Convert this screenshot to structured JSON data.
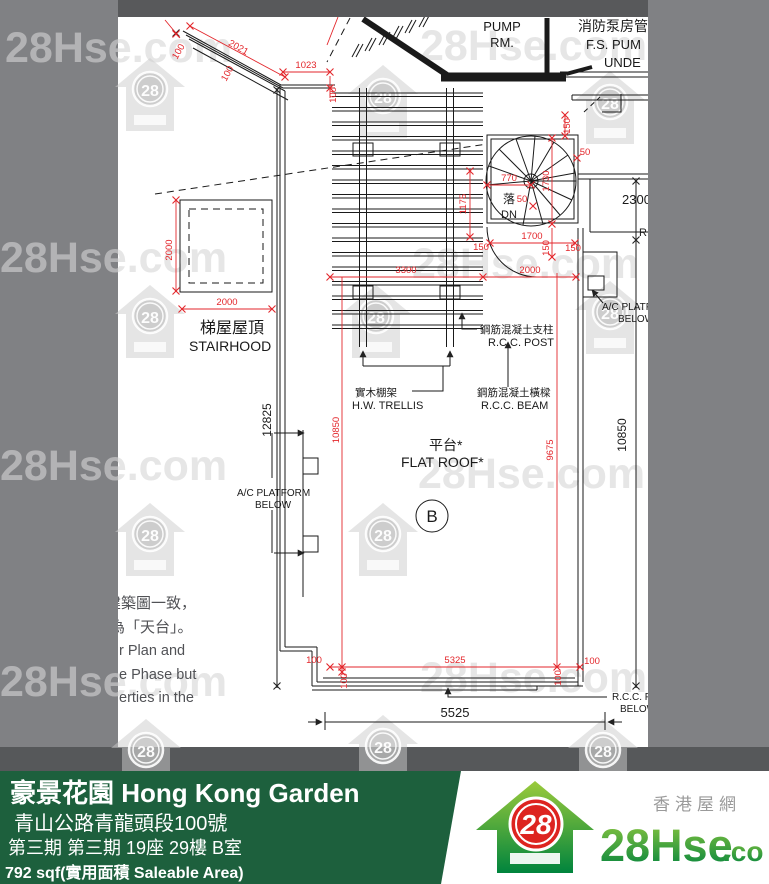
{
  "watermark": {
    "text": "28Hse.com",
    "number": "28"
  },
  "plan": {
    "labels": {
      "pump1": "PUMP",
      "pump2": "RM.",
      "fs_zh": "消防泵房管",
      "fs_en1": "F.S. PUM",
      "fs_en2": "UNDE",
      "down_zh": "落",
      "down_en": "DN",
      "stairhood_zh": "梯屋屋頂",
      "stairhood_en": "STAIRHOOD",
      "post_zh": "鋼筋混凝土支柱",
      "post_en": "R.C.C. POST",
      "trellis_zh": "實木棚架",
      "trellis_en": "H.W. TRELLIS",
      "beam_zh": "鋼筋混凝土橫樑",
      "beam_en": "R.C.C. BEAM",
      "roof_zh": "平台*",
      "roof_en": "FLAT ROOF*",
      "acl1": "A/C PLATFORM",
      "acl2": "BELOW",
      "acr1": "A/C PLATF",
      "acr2": "BELOW",
      "rc": "R.C.",
      "rccf1": "R.C.C. F",
      "rccf2": "BELOW",
      "unit": "B"
    },
    "dims": {
      "tl_100a": "100",
      "tl_2021": "2021",
      "tl_100b": "100",
      "tl_1023": "1023",
      "tl_100c": "100",
      "st_150": "150",
      "st_50a": "50",
      "st_770": "770",
      "st_1730": "1730",
      "st_1175": "1175",
      "st_50b": "50",
      "st_1700": "1700",
      "st_150a": "150",
      "st_150b": "150",
      "st_150c": "150",
      "st_2000": "2000",
      "mid_3300": "3300",
      "sh_2000v": "2000",
      "sh_2000h": "2000",
      "left_12825": "12825",
      "red_10850": "10850",
      "red_9675": "9675",
      "right_2300": "2300",
      "right_10850": "10850",
      "bot_100l": "100",
      "bot_100lr": "100",
      "bot_5325": "5325",
      "bot_100rr": "100",
      "bot_100r": "100",
      "bot_5525": "5525"
    },
    "notes": [
      "建築圖一致，",
      "為「天台」。",
      "r Plan and",
      "e Phase but",
      "erties in the"
    ]
  },
  "footer": {
    "estate_title": "豪景花園 Hong Kong Garden",
    "address": "青山公路青龍頭段100號",
    "unit_info": "第三期 第三期 19座 29樓 B室",
    "area_info": "792 sqf(實用面積 Saleable Area)",
    "brand": {
      "name_main": "28Hse",
      "name_suffix": ".com",
      "number": "28",
      "tagline_zh": "香港屋網"
    }
  },
  "colors": {
    "dimension_red": "#E3262B",
    "footer_green": "#1D603D",
    "frame_gray": "#808184",
    "frame_dark": "#58595B",
    "logo_green_light": "#9BCB3C",
    "logo_green_dark": "#00843D",
    "logo_red": "#DD2420"
  }
}
